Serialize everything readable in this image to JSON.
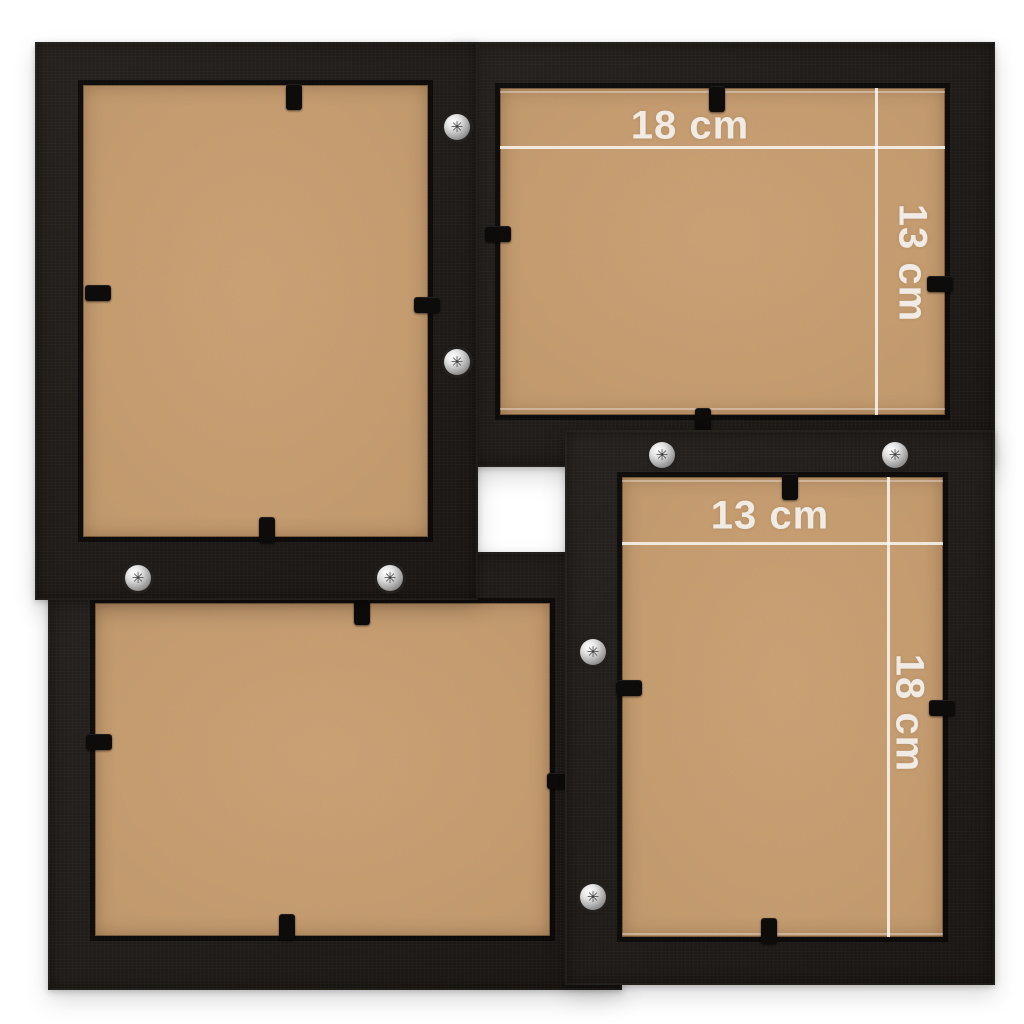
{
  "image_caption": "Rear view of a black collage photo frame holding four picture openings, with photo size annotations",
  "colors": {
    "background": "#fbfbfa",
    "frame_black": "#1d1916",
    "backing_mdf": "#c3996c",
    "annotation_white": "#f4f2ef",
    "screw_silver": "#c9c9c9"
  },
  "decor": {
    "screw_glyph": "✳"
  },
  "frames": [
    {
      "name": "top-left-frame",
      "orientation": "portrait"
    },
    {
      "name": "top-right-frame",
      "orientation": "landscape",
      "width_label": "18 cm",
      "height_label": "13 cm"
    },
    {
      "name": "bottom-right-frame",
      "orientation": "portrait",
      "width_label": "13 cm",
      "height_label": "18 cm"
    },
    {
      "name": "bottom-left-frame",
      "orientation": "landscape"
    }
  ]
}
